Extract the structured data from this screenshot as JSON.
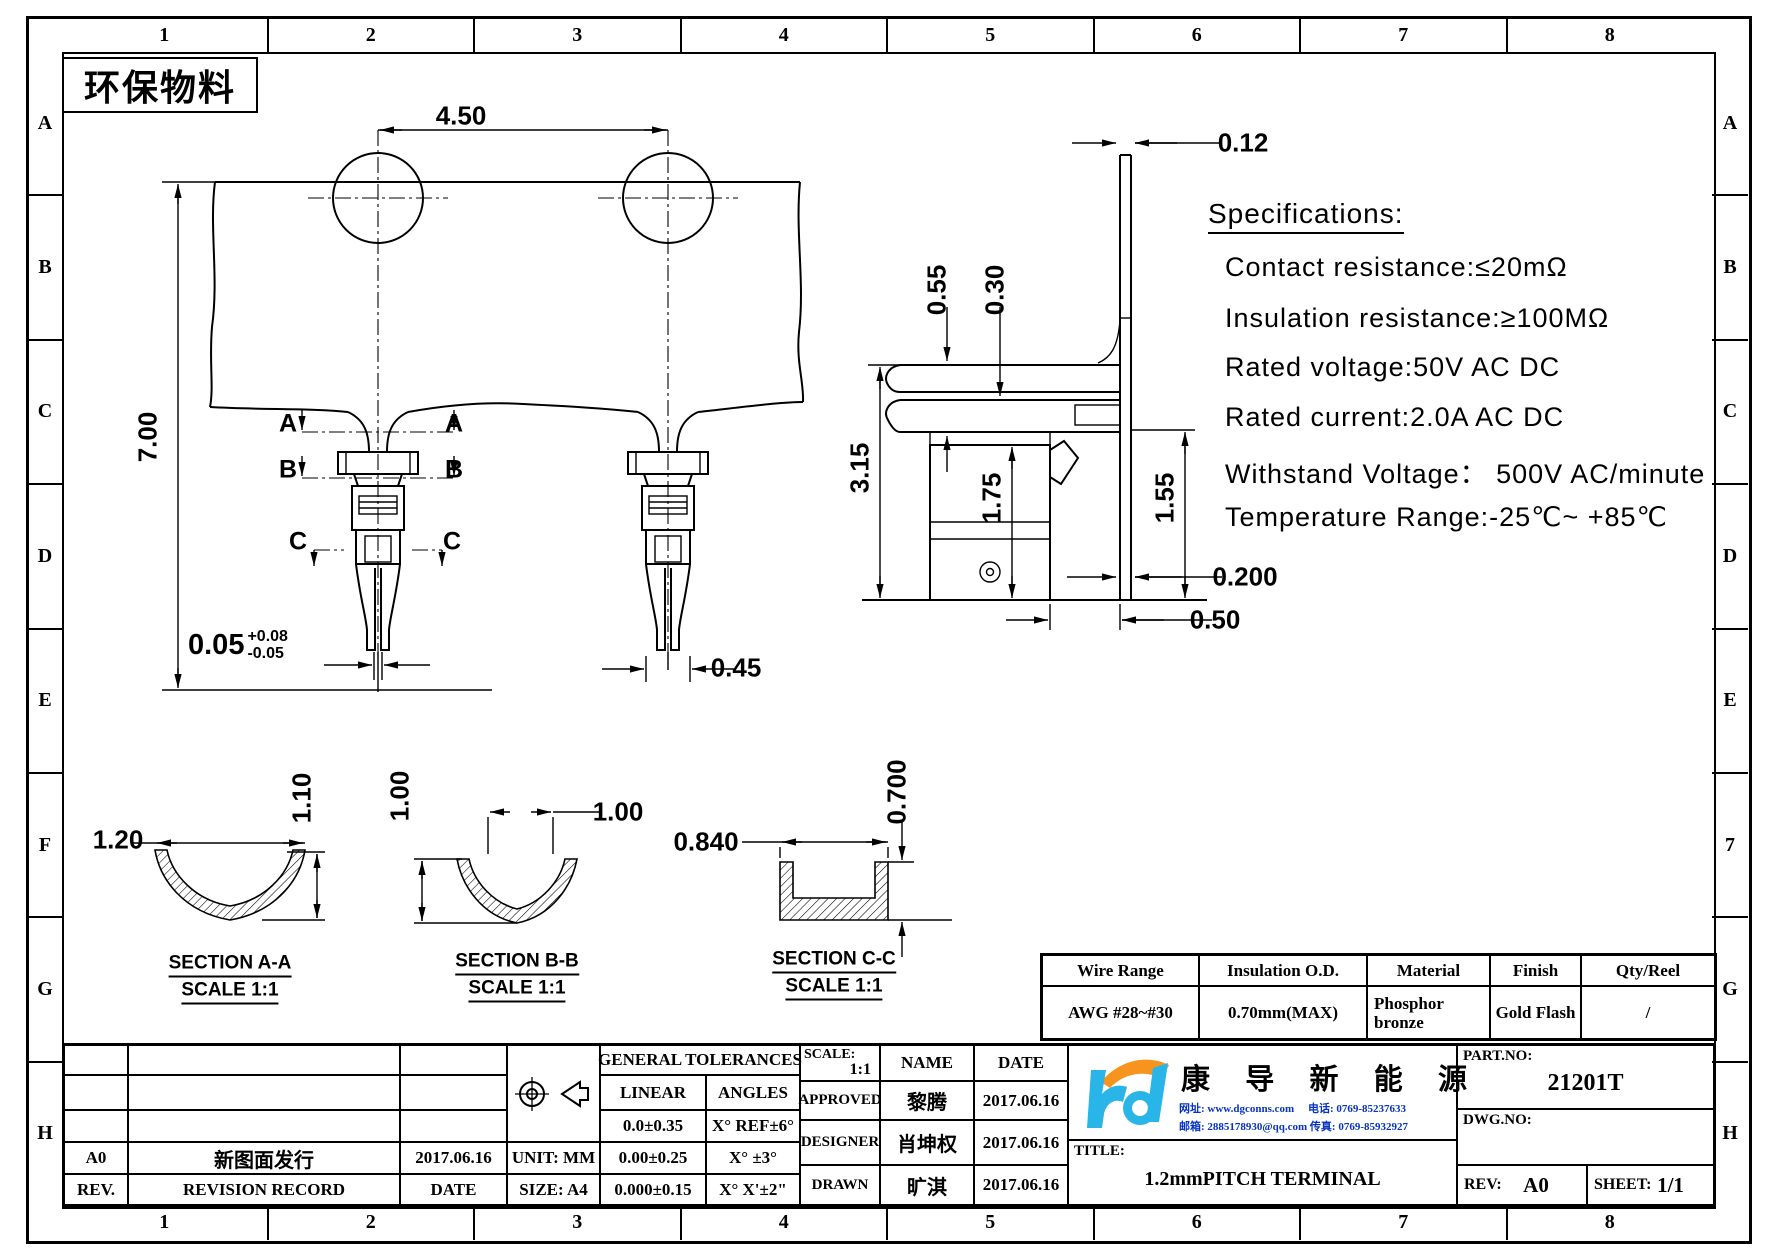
{
  "stamp": {
    "text": "环保物料"
  },
  "frame": {
    "cols": [
      "1",
      "2",
      "3",
      "4",
      "5",
      "6",
      "7",
      "8"
    ],
    "left_rows": [
      "A",
      "B",
      "C",
      "D",
      "E",
      "F",
      "G",
      "H"
    ],
    "right_rows": [
      "A",
      "B",
      "C",
      "D",
      "E",
      "7",
      "G",
      "H"
    ]
  },
  "specs": {
    "title": "Specifications:",
    "line1": "Contact resistance:≤20mΩ",
    "line2": "Insulation resistance:≥100MΩ",
    "line3": "Rated voltage:50V AC DC",
    "line4": "Rated current:2.0A AC DC",
    "line5": "Withstand Voltage： 500V AC/minute",
    "line6": "Temperature Range:-25℃~ +85℃"
  },
  "front_view": {
    "dim_pitch": "4.50",
    "dim_height": "7.00",
    "dim_tip": "0.05",
    "dim_tip_plus": "+0.08",
    "dim_tip_minus": "-0.05",
    "dim_leg": "0.45",
    "marker_a": "A",
    "marker_b": "B",
    "marker_c": "C"
  },
  "side_view": {
    "dim_thickness": "0.12",
    "dim_055": "0.55",
    "dim_030": "0.30",
    "dim_315": "3.15",
    "dim_175": "1.75",
    "dim_155": "1.55",
    "dim_0200": "0.200",
    "dim_050": "0.50"
  },
  "sections": {
    "a": {
      "title": "SECTION A-A",
      "scale": "SCALE 1:1",
      "w": "1.20",
      "h": "1.10"
    },
    "b": {
      "title": "SECTION B-B",
      "scale": "SCALE 1:1",
      "w": "1.00",
      "h": "1.00"
    },
    "c": {
      "title": "SECTION C-C",
      "scale": "SCALE 1:1",
      "w": "0.840",
      "h": "0.700"
    }
  },
  "spec_table": {
    "headers": [
      "Wire Range",
      "Insulation O.D.",
      "Material",
      "Finish",
      "Qty/Reel"
    ],
    "row": [
      "AWG #28~#30",
      "0.70mm(MAX)",
      "Phosphor\nbronze",
      "Gold Flash",
      "/"
    ]
  },
  "title_block": {
    "general_tolerances_title": "GENERAL TOLERANCES",
    "linear_header": "LINEAR",
    "angles_header": "ANGLES",
    "linear_rows": [
      "0.0±0.35",
      "0.00±0.25",
      "0.000±0.15"
    ],
    "angles_rows": [
      "X° REF±6°",
      "X° ±3°",
      "X° X'±2\""
    ],
    "unit_label": "UNIT: MM",
    "size_label": "SIZE: A4",
    "rev_value": "A0",
    "revision_desc": "新图面发行",
    "revision_date": "2017.06.16",
    "rev_header": "REV.",
    "revision_record_header": "REVISION RECORD",
    "date_header": "DATE",
    "scale_label": "SCALE:",
    "scale_value": "1:1",
    "name_header": "NAME",
    "date_header2": "DATE",
    "approved_label": "APPROVED",
    "approved_name": "黎腾",
    "approved_date": "2017.06.16",
    "designer_label": "DESIGNER",
    "designer_name": "肖坤权",
    "designer_date": "2017.06.16",
    "drawn_label": "DRAWN",
    "drawn_name": "旷淇",
    "drawn_date": "2017.06.16",
    "company_name": "康 导 新 能 源",
    "contact_line1": "网址: www.dgconns.com　 电话: 0769-85237633",
    "contact_line2": "邮箱: 2885178930@qq.com 传真: 0769-85932927",
    "title_label": "TITLE:",
    "title_value": "1.2mmPITCH TERMINAL",
    "part_no_label": "PART.NO:",
    "part_no": "21201T",
    "dwg_no_label": "DWG.NO:",
    "rev_label": "REV:",
    "rev": "A0",
    "sheet_label": "SHEET:",
    "sheet": "1/1"
  },
  "colors": {
    "logo_blue": "#29b5e8",
    "logo_orange": "#f7941d",
    "contact_blue": "#0633c4"
  }
}
